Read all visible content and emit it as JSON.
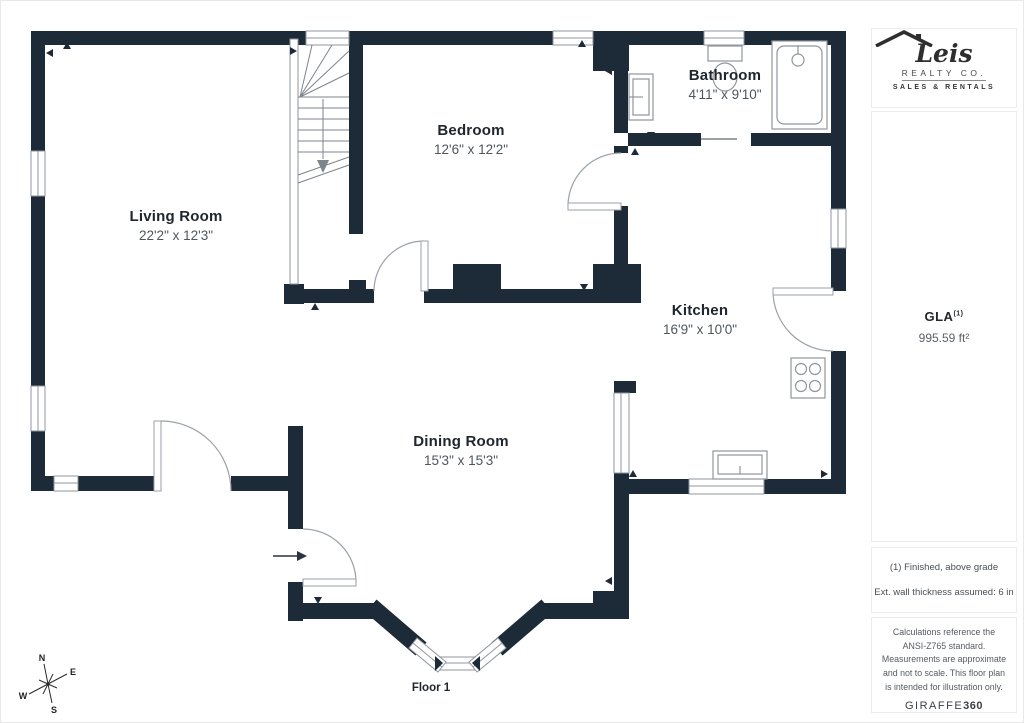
{
  "plan": {
    "rooms": [
      {
        "name": "Living Room",
        "dims": "22'2\" x 12'3\""
      },
      {
        "name": "Bedroom",
        "dims": "12'6\" x 12'2\""
      },
      {
        "name": "Bathroom",
        "dims": "4'11\" x 9'10\""
      },
      {
        "name": "Kitchen",
        "dims": "16'9\" x 10'0\""
      },
      {
        "name": "Dining Room",
        "dims": "15'3\" x 15'3\""
      }
    ],
    "floor_label": "Floor 1",
    "wall_color": "#1d2a38"
  },
  "compass": {
    "n": "N",
    "e": "E",
    "s": "S",
    "w": "W"
  },
  "sidebar": {
    "logo": {
      "name": "Leis",
      "subtitle": "REALTY CO.",
      "tagline": "SALES & RENTALS"
    },
    "gla": {
      "label": "GLA",
      "sup": "(1)",
      "value": "995.59 ft²"
    },
    "notes": [
      "(1) Finished, above grade",
      "Ext. wall thickness assumed: 6 in"
    ],
    "disclaimer": "Calculations reference the ANSI-Z765 standard. Measurements are approximate and not to scale. This floor plan is intended for illustration only.",
    "brand": {
      "name": "GIRAFFE",
      "suffix": "360"
    }
  }
}
